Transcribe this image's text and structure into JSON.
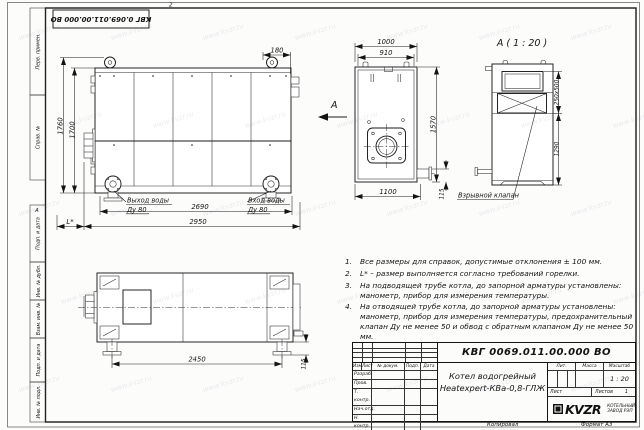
{
  "sheet": {
    "zone_top": "2",
    "zone_left": "А",
    "top_stamp": "КВГ 0.069.011.00.000 ВО",
    "watermark": "www.kvzr.ru",
    "margin_labels": [
      "Перв. примен.",
      "Справ. №",
      "Подп. и дата",
      "Инв. № дубл.",
      "Взам. инв. №",
      "Подп. и дата",
      "Инв. № подл."
    ],
    "footer_copied": "Копировал",
    "footer_format": "Формат А3"
  },
  "views": {
    "side": {
      "dim_top": "180",
      "dim_height_outer": "1760",
      "dim_height_inner": "1700",
      "dim_flanges": "2690",
      "dim_length": "2950",
      "dim_burner": "L*",
      "outlet_line1": "Выход воды",
      "outlet_line2": "Ду 80",
      "inlet_line1": "Вход воды",
      "inlet_line2": "Ду 80",
      "view_letter": "А"
    },
    "front": {
      "dim_width_outer": "1000",
      "dim_width_inner": "910",
      "dim_height": "1570",
      "dim_bottom": "1100",
      "dim_stub": "115"
    },
    "detail": {
      "title": "А ( 1 : 20 )",
      "dim_opening": "250x500",
      "dim_height": "1290",
      "valve_label": "Взрывной клапан"
    },
    "plan": {
      "dim_feet": "2450",
      "dim_foot_height": "115"
    }
  },
  "notes": [
    {
      "num": "1.",
      "text": "Все размеры для справок, допустимые отклонения ± 100 мм."
    },
    {
      "num": "2.",
      "text": "L* – размер выполняется согласно требований горелки."
    },
    {
      "num": "3.",
      "text": "На подводящей трубе котла, до запорной арматуры установлены: манометр, прибор для измерения температуры."
    },
    {
      "num": "4.",
      "text": "На отводящей трубе котла, до запорной арматуры установлены: манометр, прибор для измерения температуры, предохранительный клапан Ду не менее 50 и обвод с обратным клапаном Ду не менее 50 мм."
    }
  ],
  "title_block": {
    "designation": "КВГ 0069.011.00.000 ВО",
    "name_line1": "Котел водогрейный",
    "name_line2": "Heatexpert-КВа-0,8-ГЛЖ",
    "cols": [
      "Изм",
      "Лист",
      "№ докум.",
      "Подп.",
      "Дата"
    ],
    "rows": [
      "Разраб.",
      "Пров.",
      "Т. контр.",
      "Нач.отд.",
      "Н. контр.",
      "Утв."
    ],
    "lit": "Лит.",
    "mass": "Масса",
    "scale_label": "Масштаб",
    "scale": "1 : 20",
    "sheet_label": "Лист",
    "sheets_label": "Листов",
    "sheets_value": "1",
    "logo": "KVZR",
    "company_line1": "КОТЕЛЬНЫЙ",
    "company_line2": "ЗАВОД РЭП"
  }
}
